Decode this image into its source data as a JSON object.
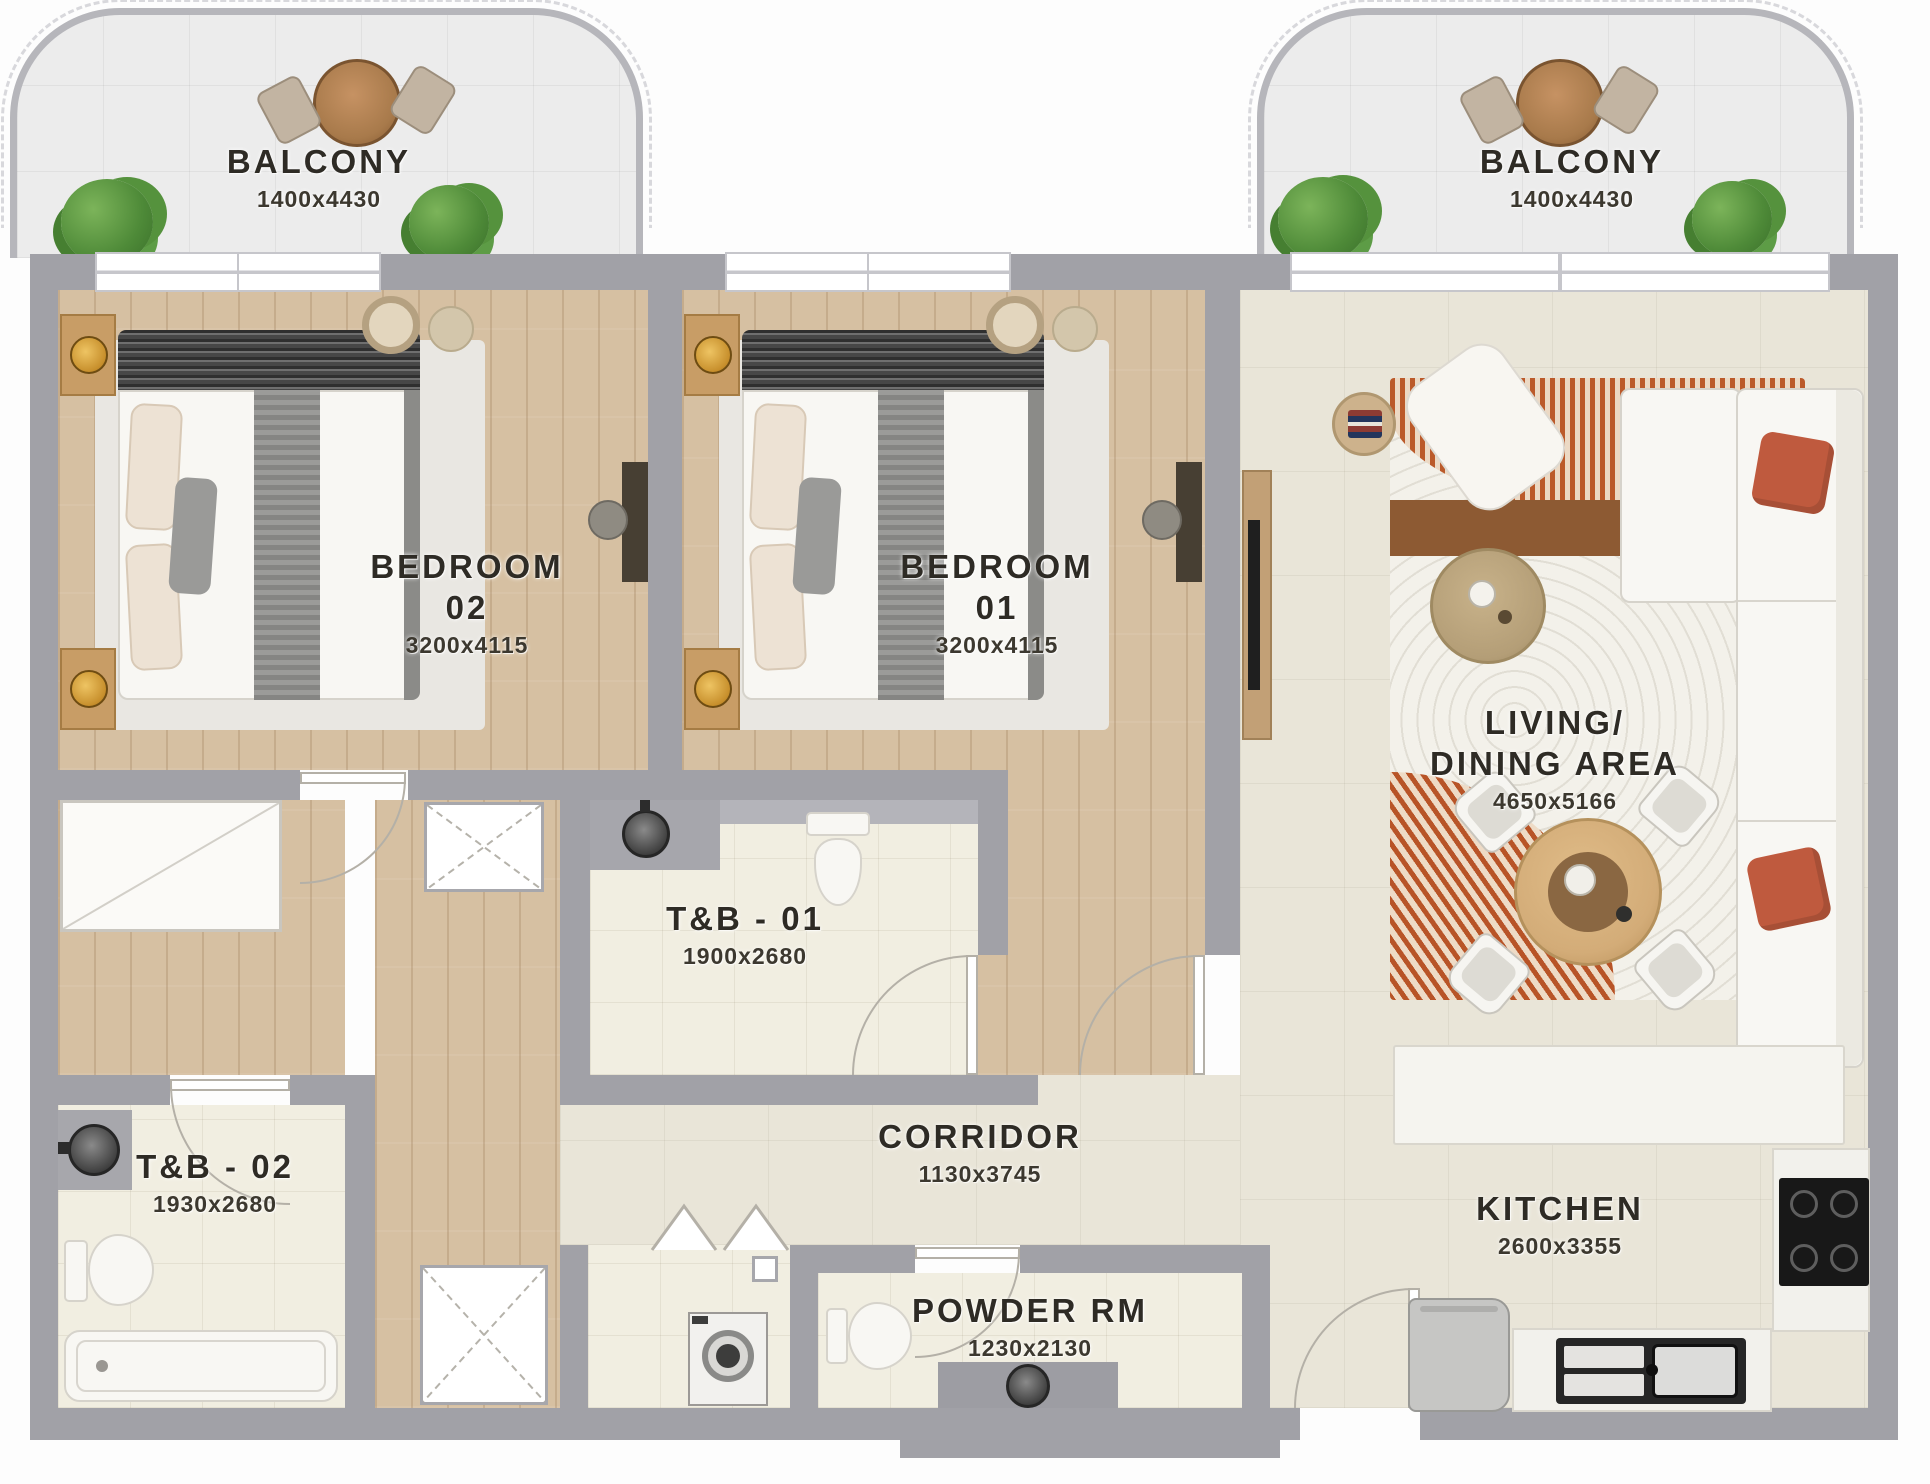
{
  "rooms": {
    "balcony_left": {
      "name": "BALCONY",
      "dims": "1400x4430"
    },
    "balcony_right": {
      "name": "BALCONY",
      "dims": "1400x4430"
    },
    "bedroom_02": {
      "name": "BEDROOM",
      "number": "02",
      "dims": "3200x4115"
    },
    "bedroom_01": {
      "name": "BEDROOM",
      "number": "01",
      "dims": "3200x4115"
    },
    "living_dining": {
      "name_line1": "LIVING/",
      "name_line2": "DINING AREA",
      "dims": "4650x5166"
    },
    "tb_01": {
      "name": "T&B - 01",
      "dims": "1900x2680"
    },
    "tb_02": {
      "name": "T&B - 02",
      "dims": "1930x2680"
    },
    "corridor": {
      "name": "CORRIDOR",
      "dims": "1130x3745"
    },
    "powder_rm": {
      "name": "POWDER RM",
      "dims": "1230x2130"
    },
    "kitchen": {
      "name": "KITCHEN",
      "dims": "2600x3355"
    }
  },
  "colors": {
    "wall": "#a1a1a7",
    "wood_floor": "#d6c0a2",
    "tile_floor": "#e9e5d8",
    "bath_floor": "#f1eee1",
    "accent_rug_orange": "#bb5a2a",
    "sofa_pillow_rust": "#bf5a3e",
    "plant_green": "#4e8a38",
    "label_text": "#2e2b25"
  }
}
